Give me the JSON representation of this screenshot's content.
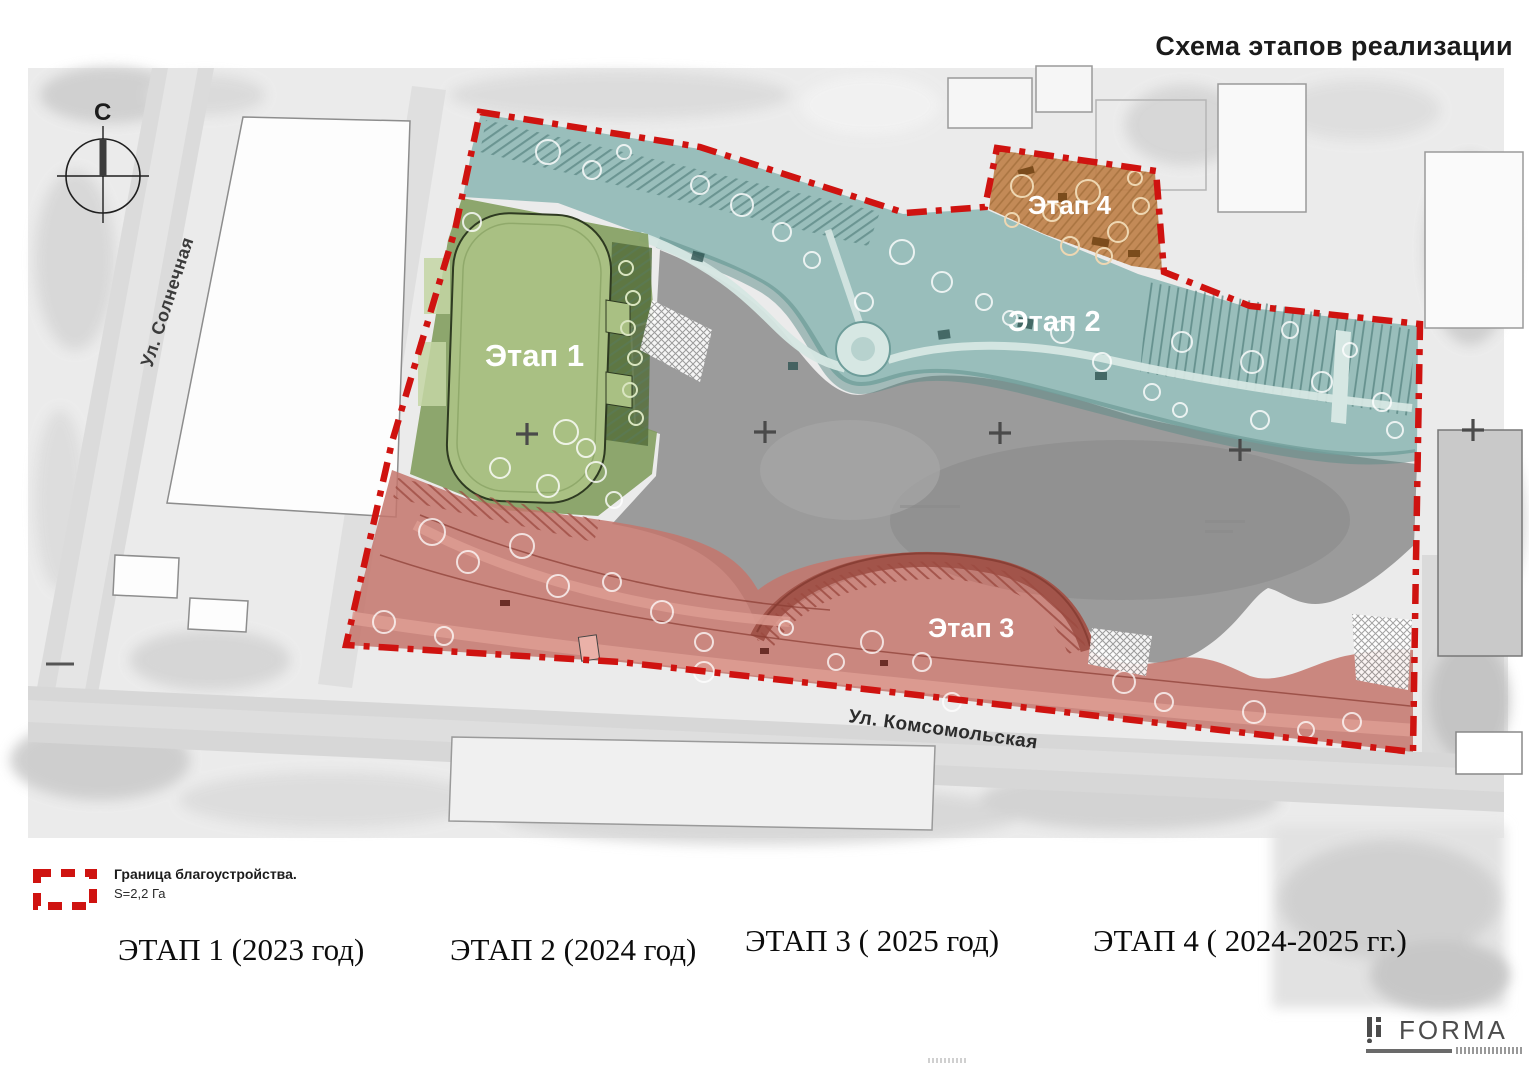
{
  "title": "Схема этапов реализации",
  "compass": {
    "north": "С"
  },
  "streets": {
    "left": "Ул. Солнечная",
    "bottom": "Ул. Комсомольская"
  },
  "zones": [
    {
      "label": "Этап 1",
      "caption": "ЭТАП 1 (2023 год)",
      "color": "#7f9c5b"
    },
    {
      "label": "Этап 2",
      "caption": "ЭТАП 2 (2024 год)",
      "color": "#86b3b0"
    },
    {
      "label": "Этап 3",
      "caption": "ЭТАП 3 ( 2025 год)",
      "color": "#c4766c"
    },
    {
      "label": "Этап 4",
      "caption": "ЭТАП 4 ( 2024-2025 гг.)",
      "color": "#bf7f47"
    }
  ],
  "legend": {
    "boundary_label": "Граница благоустройства.",
    "area_label": "S=2,2 Га",
    "boundary_color": "#cf1310"
  },
  "logo": {
    "text": "FORMA"
  }
}
